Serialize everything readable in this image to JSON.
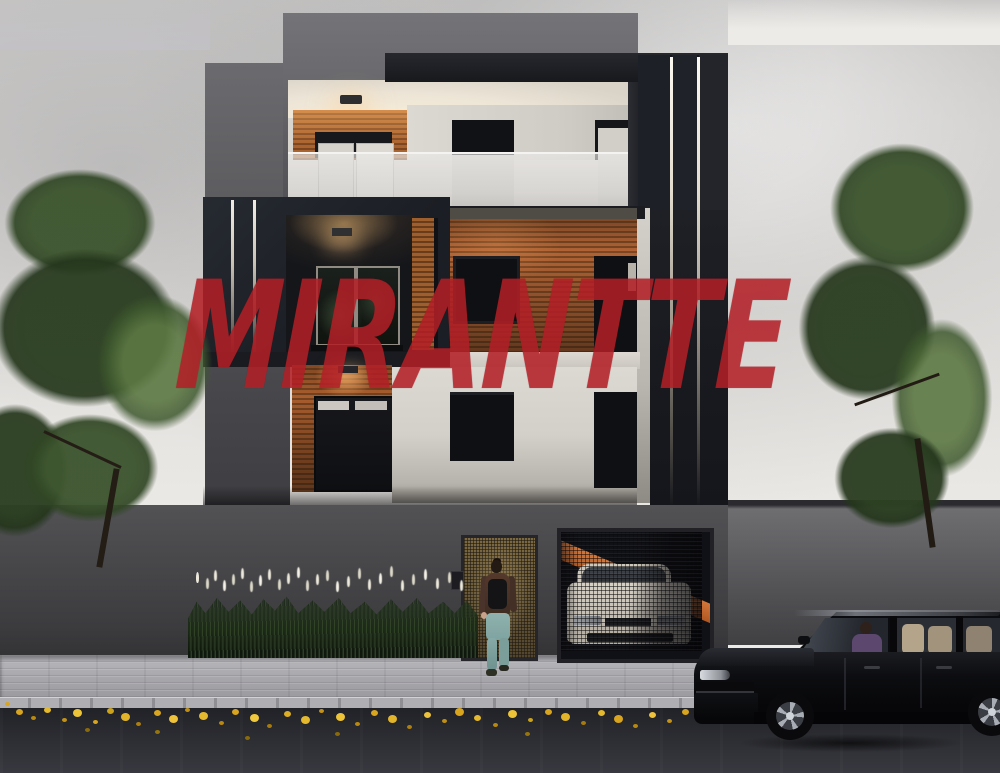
{
  "scene": {
    "type": "exterior architectural rendering at dusk, three-story modern residence with street scene",
    "watermark": {
      "text": "MIRANTTE",
      "color": "#b92129"
    },
    "palette": {
      "sky": "#dedcd9",
      "building_charcoal": "#1e2126",
      "building_gray": "#5b5b5f",
      "white_wall": "#d9d5cf",
      "wood_slats": "#a45a2b",
      "led_strip": "#f2efe6",
      "balcony_glass": "#e4e3e1",
      "garage_stripe_orange": "#c3662c",
      "gate_mesh_bronze": "#6e5b38",
      "fence_gray": "#434346",
      "sidewalk": "#a9a8ad",
      "street_asphalt": "#2b2c31",
      "fallen_leaves_yellow": "#d9a41e",
      "grass_plumes_white": "#ece8db",
      "tree_green": "#3c5430",
      "car_black": "#0c0d10",
      "car_seats_beige": "#b3a48a",
      "driver_sweater_purple": "#5c486e",
      "pedestrian_top_brown": "#4a352a",
      "pedestrian_jeans_teal": "#8fb2ae",
      "garage_car_white": "#d6d0c4"
    }
  }
}
